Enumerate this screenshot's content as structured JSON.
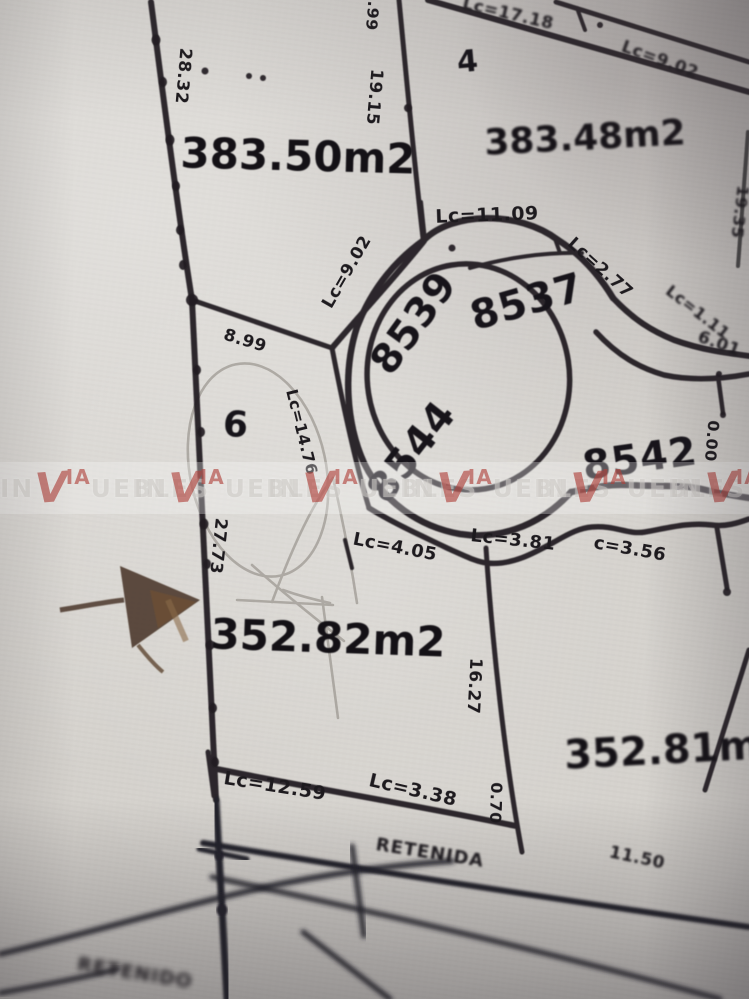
{
  "title": "Cadastral plat map photo",
  "watermark": {
    "prefix": "IN",
    "v": "V",
    "ia": "IA",
    "rest": "UEBLES",
    "red": "#b0403a"
  },
  "lots": {
    "lot4_number": "4",
    "lot4_area": "383.48m2",
    "lot_left_area": "383.50m2",
    "lot6_number": "6",
    "lot_center_area": "352.82m2",
    "lot_right_area": "352.81m2",
    "parcel_8539": "8539",
    "parcel_8537": "8537",
    "parcel_8544": "8544",
    "parcel_8542": "8542"
  },
  "measurements": {
    "m28_32": "28.32",
    "m1_99": "1.99",
    "m19_15": "19.15",
    "lc17_18": "Lc=17.18",
    "lc9_02_top": "Lc=9.02",
    "lc11_09": "Lc=11.09",
    "lc9_02": "Lc=9.02",
    "lc2_77": "Lc=2.77",
    "lc1_11": "Lc=1.11",
    "m6_01": "6.01",
    "m19_35": "19.35",
    "m0_00": "0.00",
    "m8_99": "8.99",
    "lc14_76": "Lc=14.76",
    "m27_73": "27.73",
    "lc4_05": "Lc=4.05",
    "lc3_81": "Lc=3.81",
    "c3_56": "c=3.56",
    "m16_27": "16.27",
    "m0_70": "0.70",
    "lc12_59": "Lc=12.59",
    "lc3_38": "Lc=3.38",
    "m11_50": "11.50"
  },
  "streets": {
    "retenida": "RETENIDA",
    "retenido": "RETENIDO"
  }
}
